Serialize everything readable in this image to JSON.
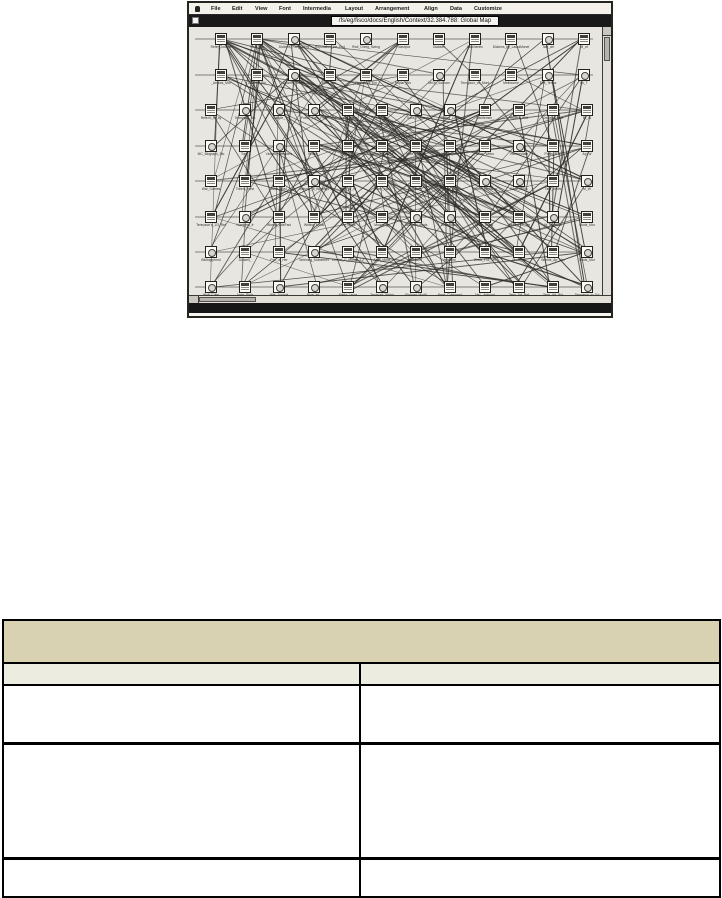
{
  "page": {
    "background": "#ffffff"
  },
  "figure": {
    "window": {
      "menu": {
        "apple_icon": "apple-logo",
        "items": [
          "File",
          "Edit",
          "View",
          "Font",
          "Intermedia",
          "Layout",
          "Arrangement",
          "Align",
          "Data",
          "Customize"
        ]
      },
      "title_path": "/fs/eg/fisco/docs/English/Context/32.384.788: Global Map",
      "map": {
        "seed": 11,
        "line_count": 170,
        "extra_dense_lines": 50,
        "rows": [
          {
            "y": 6,
            "x0": 26,
            "dx": 36.3,
            "labels": [
              "Refer_Journal",
              "Sw'ft_Bio",
              "Dickens_Fairy_TlPts",
              "Reputation_the_End",
              "Rwil_Chmg_Swing",
              "T'dashpot",
              "Dialdom",
              "Butcheries",
              "Dickens_by_LauraMonet",
              "Tale_arl",
              "M_of"
            ]
          },
          {
            "y": 42,
            "x0": 26,
            "dx": 36.3,
            "labels": [
              "_Arrows_Mor",
              "Dickens_Bio",
              "Dickens_Debts",
              "Beer_Mar_",
              "Church_of_Em",
              "Poplar_Bio",
              "MrCh_Sullivan",
              "Tennyson_vs_Mont",
              "Melbourne",
              "Elm_Terms",
              "Im_T"
            ]
          },
          {
            "y": 77,
            "x0": 16,
            "dx": 34.2,
            "labels": [
              "Refer'd_to_by",
              "Tennyson_Bib",
              "Carlyle_",
              "Poetic_Free_Poet",
              "Poet_Lovers",
              "Tess_Av",
              "Sons_Poem",
              "Styling_Crbtn",
              "Gentlemen_",
              "Stylers_Wrlt",
              "Dickens_Und",
              "Br_W"
            ]
          },
          {
            "y": 113,
            "x0": 16,
            "dx": 34.2,
            "labels": [
              "MC_Biograph_Bio",
              "Tory_",
              "Victoria_Websters",
              "Brown_",
              "Mich_Selv",
              "Mourning_Beck",
              "Mike_Webstr",
              "Wilson_Mdl",
              "Dissr_Webs",
              "Intermediate",
              "Partls_RTC",
              "Ap_W"
            ]
          },
          {
            "y": 148,
            "x0": 16,
            "dx": 34.2,
            "labels": [
              "War_Games",
              "Tollers_Nest",
              "Alice_Novl",
              "Victoria_of_Beckngs",
              "Mich_of_W",
              "Tenn_Lwr",
              "Websters_",
              "Nectrn_Mod",
              "Rome_Verbatim",
              "Beck_Mods",
              "Tale_Webs",
              "M_W"
            ]
          },
          {
            "y": 184,
            "x0": 16,
            "dx": 34.2,
            "labels": [
              "Tennyson's_1/3_Ref",
              "Numbers_fr",
              "Worlds_adeFact",
              "Writing_Mods",
              "Arg_Mods",
              "Mourning_",
              "Tale_law_Mods",
              "Elem_Mods",
              "Wks_Mods",
              "Webs_Full_Ver",
              "W_in_Mods",
              "Mods_Mor"
            ]
          },
          {
            "y": 219,
            "x0": 16,
            "dx": 34.2,
            "labels": [
              "Bibliogrphmd",
              "Durwell_",
              "Poe_is_Her",
              "Writming_Mdbstreet",
              "Cricket_C_Monet_1.2",
              "Arab_Mods",
              "Websters_",
              "Verbatim_",
              "Wrlds_Full_Ver",
              "Mods_W",
              "Worlds_Ap_Mor",
              "Mods_Mor"
            ]
          },
          {
            "y": 254,
            "x0": 16,
            "dx": 34.2,
            "labels": [
              "Wolf_Cubs",
              "Apes_Picts",
              "War_Journal",
              "Blue_art_",
              "Maria_Laura",
              "Treasure_Webd",
              "Richard_Mod8",
              "Beas_Cubsword",
              "MsL_Artword",
              "Tens_Art_Ref",
              "Tenn_Art_Wd",
              "Tennyson_to_Ed"
            ]
          }
        ]
      },
      "colors": {
        "map_bg": "#e8e6e0",
        "menu_bg": "#f3f1ea",
        "title_bg": "#191919",
        "link_line": "#2e2c29",
        "frame": "#26241f"
      }
    }
  },
  "table": {
    "header_label": "",
    "columns": [
      {
        "label": ""
      },
      {
        "label": ""
      }
    ],
    "rows": [
      {
        "c1": "",
        "c2": ""
      },
      {
        "c1": "",
        "c2": ""
      },
      {
        "c1": "",
        "c2": ""
      }
    ],
    "colors": {
      "header_bg": "#d8d2b3",
      "subheader_bg": "#ecece0",
      "border": "#000000"
    }
  }
}
